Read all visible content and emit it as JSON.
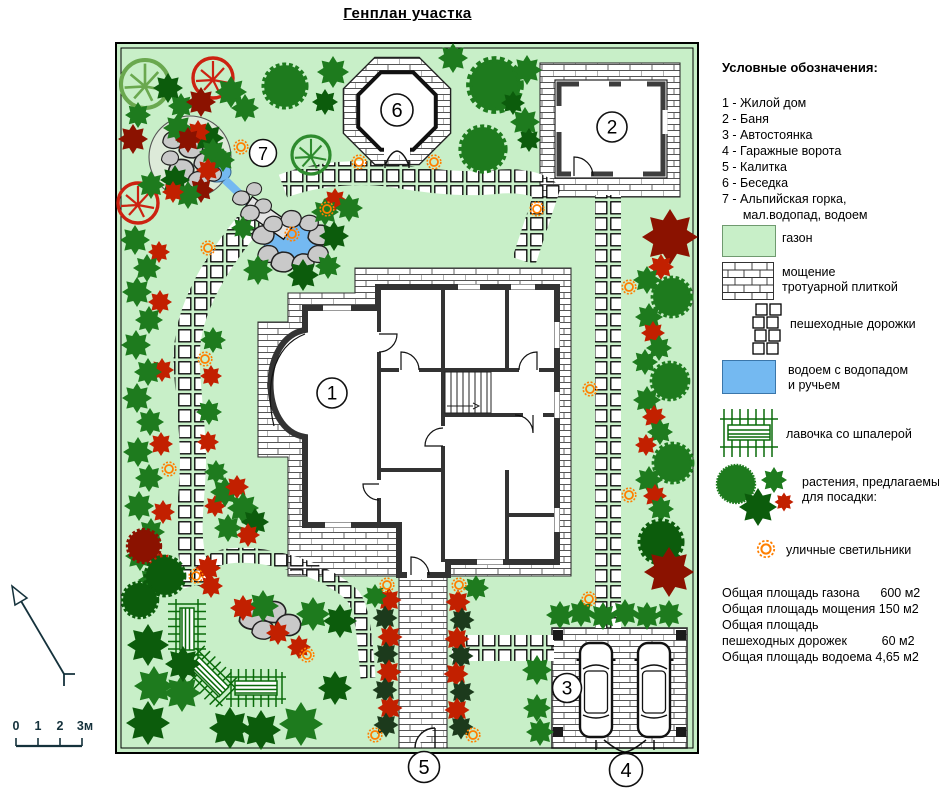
{
  "title": "Генплан участка",
  "legend": {
    "title": "Условные обозначения:",
    "items": [
      "1 - Жилой дом",
      "2 - Баня",
      "3 - Автостоянка",
      "4 - Гаражные ворота",
      "5 - Калитка",
      "6 - Беседка",
      "7 - Альпийская горка,\n      мал.водопад, водоем"
    ],
    "swatches": [
      {
        "key": "lawn",
        "label": "газон"
      },
      {
        "key": "paving",
        "label": "мощение\nтротуарной плиткой"
      },
      {
        "key": "walkways",
        "label": "пешеходные дорожки"
      },
      {
        "key": "pond",
        "label": "водоем с водопадом\nи ручьем"
      },
      {
        "key": "bench",
        "label": "лавочка со шпалерой"
      },
      {
        "key": "plants",
        "label": "растения, предлагаемые\nдля посадки:"
      },
      {
        "key": "lamps",
        "label": "уличные светильники"
      }
    ],
    "stats": [
      "Общая площадь газона      600 м2",
      "Общая площадь мощения 150 м2",
      "Общая площадь",
      "пешеходных дорожек          60 м2",
      "Общая площадь водоема 4,65 м2"
    ]
  },
  "plan": {
    "markers": {
      "house": "1",
      "banya": "2",
      "parking": "3",
      "garage": "4",
      "gate": "5",
      "gazebo": "6",
      "alpine": "7"
    }
  },
  "scale_bar": {
    "labels": [
      "0",
      "1",
      "2",
      "3м"
    ]
  },
  "colors": {
    "lawn": "#c8efc8",
    "water": "#74b9f1",
    "lamp": "#ff7f00",
    "tree_green": "#1e7b1e",
    "tree_dark": "#0c5c0c",
    "bush_red": "#c22000",
    "bush_maroon": "#8b1200",
    "bush_black": "#1c3a1c",
    "rock": "#c9c9c9",
    "bench": "#0a6b0a",
    "compass": "#15323c"
  }
}
